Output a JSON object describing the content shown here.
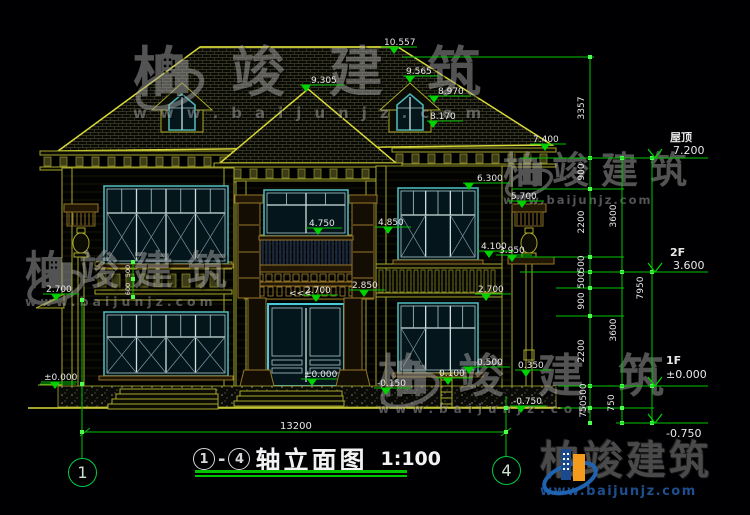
{
  "title": {
    "c1": "1",
    "c2": "4",
    "dash": "-",
    "name": "轴立面图",
    "scale": "1:100"
  },
  "watermark": {
    "brand": "柏竣建筑",
    "url": "www.baijunjz.com"
  },
  "axis_bubbles": {
    "left": "1",
    "right": "4"
  },
  "bottom_dim": {
    "t": "13200",
    "x": 280,
    "y": 429
  },
  "levels": [
    {
      "name": "屋顶",
      "value": "7.200",
      "nx": 670,
      "ny": 141,
      "vx": 673,
      "vy": 154,
      "lineY": 158,
      "x1": 520,
      "x2": 708,
      "tip": 655
    },
    {
      "name": "2F",
      "value": "3.600",
      "nx": 670,
      "ny": 256,
      "vx": 673,
      "vy": 269,
      "lineY": 272,
      "x1": 520,
      "x2": 708,
      "tip": 655
    },
    {
      "name": "1F",
      "value": "±0.000",
      "nx": 666,
      "ny": 364,
      "vx": 666,
      "vy": 378,
      "lineY": 386,
      "x1": 558,
      "x2": 708,
      "tip": 655
    },
    {
      "name": "",
      "value": "-0.750",
      "nx": 666,
      "ny": 437,
      "vx": 666,
      "vy": 437,
      "lineY": 423,
      "x1": 616,
      "x2": 708,
      "tip": 655
    }
  ],
  "flags": [
    {
      "t": "10.557",
      "x": 384,
      "y": 45,
      "tx": 394
    },
    {
      "t": "9.565",
      "x": 406,
      "y": 74,
      "tx": 410
    },
    {
      "t": "8.970",
      "x": 438,
      "y": 94,
      "tx": 434
    },
    {
      "t": "8.170",
      "x": 430,
      "y": 119,
      "tx": 433
    },
    {
      "t": "9.305",
      "x": 311,
      "y": 83,
      "tx": 306
    },
    {
      "t": "7.400",
      "x": 533,
      "y": 142,
      "tx": 545
    },
    {
      "t": "6.300",
      "x": 477,
      "y": 181,
      "tx": 469
    },
    {
      "t": "5.700",
      "x": 511,
      "y": 199,
      "tx": 522
    },
    {
      "t": "4.850",
      "x": 352,
      "y": 289,
      "tx": 366,
      "skip": true
    },
    {
      "t": "4.850",
      "x": 378,
      "y": 225,
      "tx": 388
    },
    {
      "t": "4.750",
      "x": 309,
      "y": 226,
      "tx": 318
    },
    {
      "t": "4.100",
      "x": 481,
      "y": 249,
      "tx": 489
    },
    {
      "t": "3.950",
      "x": 499,
      "y": 253,
      "tx": 512
    },
    {
      "t": "2.850",
      "x": 352,
      "y": 288,
      "tx": 364
    },
    {
      "t": "2.700",
      "x": 305,
      "y": 293,
      "tx": 316
    },
    {
      "t": "<<<",
      "x": 289,
      "y": 296,
      "plain": true
    },
    {
      "t": "2.700",
      "x": 478,
      "y": 292,
      "tx": 486
    },
    {
      "t": "2.700",
      "x": 46,
      "y": 292,
      "tx": 56
    },
    {
      "t": "±0.000",
      "x": 44,
      "y": 380,
      "tx": 55
    },
    {
      "t": "±0.000",
      "x": 304,
      "y": 377,
      "tx": 312
    },
    {
      "t": "-0.150",
      "x": 377,
      "y": 386,
      "tx": 386
    },
    {
      "t": "0.500",
      "x": 477,
      "y": 365,
      "tx": 469
    },
    {
      "t": "0.350",
      "x": 518,
      "y": 368,
      "tx": 526
    },
    {
      "t": "0.100",
      "x": 439,
      "y": 376,
      "tx": 448
    },
    {
      "t": "-0.750",
      "x": 513,
      "y": 404,
      "tx": 521
    }
  ],
  "chain_labels": [
    {
      "t": "3357",
      "x": 584,
      "y": 108
    },
    {
      "t": "900",
      "x": 584,
      "y": 172
    },
    {
      "t": "2200",
      "x": 584,
      "y": 222
    },
    {
      "t": "500",
      "x": 584,
      "y": 264
    },
    {
      "t": "500",
      "x": 584,
      "y": 280
    },
    {
      "t": "900",
      "x": 584,
      "y": 301
    },
    {
      "t": "2200",
      "x": 584,
      "y": 351
    },
    {
      "t": "500",
      "x": 586,
      "y": 392
    },
    {
      "t": "750",
      "x": 586,
      "y": 409
    },
    {
      "t": "3600",
      "x": 616,
      "y": 216
    },
    {
      "t": "3600",
      "x": 616,
      "y": 330
    },
    {
      "t": "750",
      "x": 614,
      "y": 403
    },
    {
      "t": "7950",
      "x": 643,
      "y": 288
    },
    {
      "t": "500",
      "x": 130,
      "y": 271,
      "small": true
    },
    {
      "t": "600",
      "x": 130,
      "y": 289,
      "small": true
    }
  ]
}
